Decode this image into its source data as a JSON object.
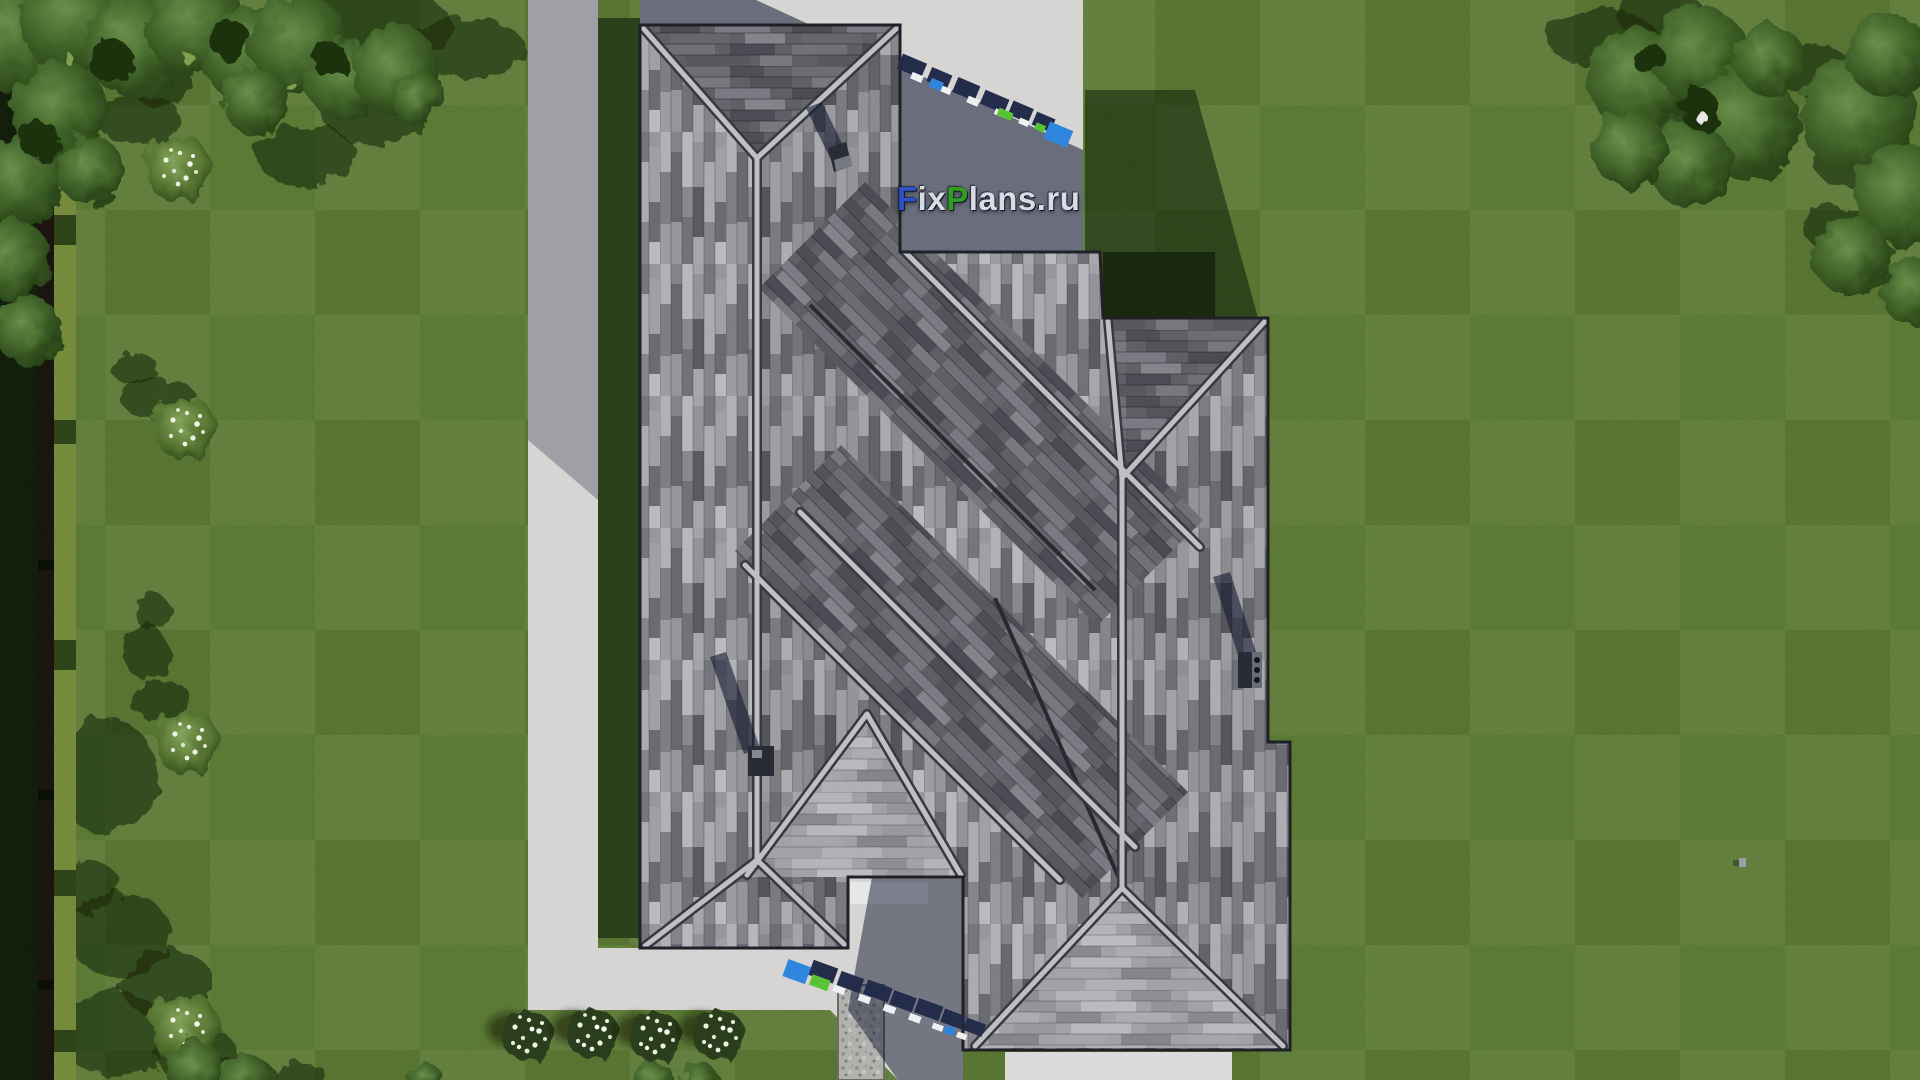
{
  "watermark": {
    "site_label": {
      "full_text": "FixPlans.ru",
      "segments": [
        {
          "text": "F",
          "color": "#2e50c8"
        },
        {
          "text": "ix",
          "color": "#d9dce4"
        },
        {
          "text": "P",
          "color": "#2f9f1d"
        },
        {
          "text": "lans",
          "color": "#d9dce4"
        },
        {
          "text": ".ru",
          "color": "#d9dce4"
        }
      ]
    }
  },
  "palette": {
    "lawn": "#67893c",
    "lawn_shadow": "#2f481d",
    "hedge_dark": "#18270f",
    "hedge_bright": "#93b04c",
    "concrete": "#d6d5d3",
    "concrete_shadow": "#59617a",
    "roof_base": "#96969c",
    "roof_band_dark": "#64646c",
    "roof_ridge": "#c8c8ce",
    "chimney": "#2b2f3a",
    "marker_blue": "#2e86de",
    "marker_green": "#58c433",
    "marker_white": "#eef0f4",
    "marker_shadow_navy": "#232c4a"
  }
}
